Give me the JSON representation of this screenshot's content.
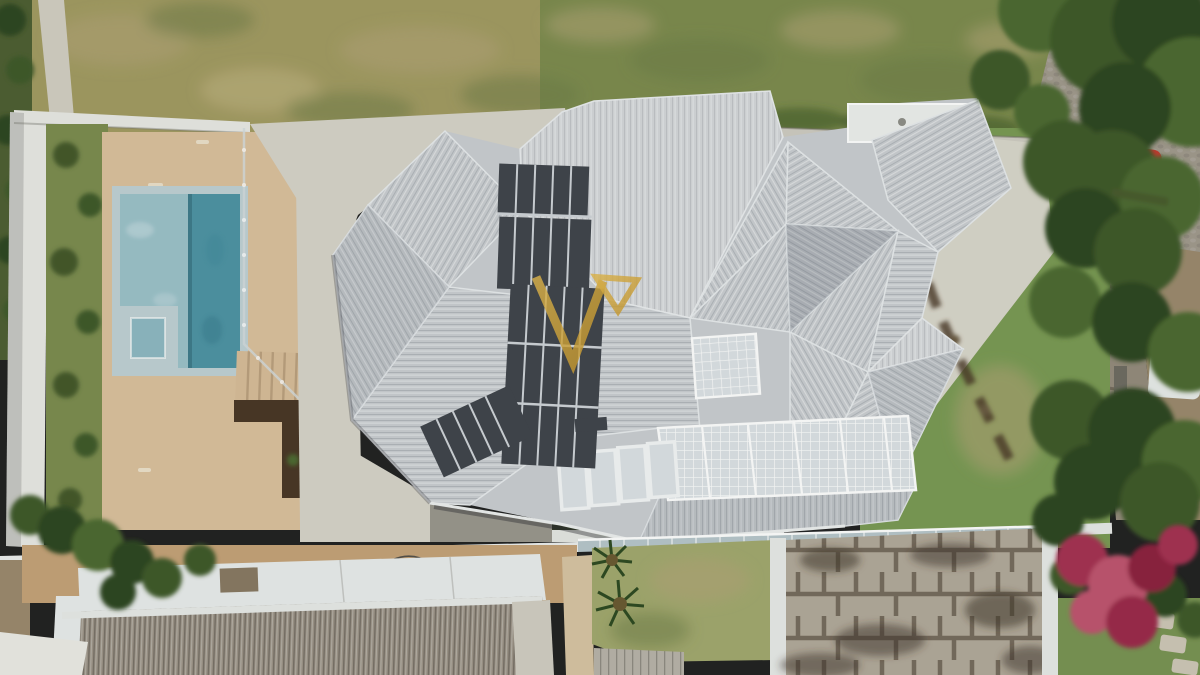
{
  "scene": {
    "type": "aerial-drone-photograph",
    "description": "Top-down aerial view of a modern residence with a multi-faceted light gray roof, rooftop solar collectors and gridded skylights, a swimming pool with tan deck and spa on the left, lawns, a curved concrete driveway, a cobbled street with parked red car and white van at right under large trees, and neighboring houses along the bottom with corrugated roof, palm lawn, weathered stone patio and magenta bougainvillea.",
    "visible_text": "",
    "watermark": {
      "shape": "gold outlined V with small inverted triangle (logo monogram)",
      "position": "center of roof"
    }
  },
  "elements": [
    {
      "name": "house-roof",
      "desc": "gray ribbed hip roof, many facets with white ridge lines"
    },
    {
      "name": "solar-arrays",
      "desc": "dark solar water-heating strips on left roof planes"
    },
    {
      "name": "skylight-grid",
      "desc": "white gridded glass roof sections, center and lower band"
    },
    {
      "name": "pool",
      "desc": "rectangular pool, light shallow half and deep teal half, square spa"
    },
    {
      "name": "pool-deck",
      "desc": "tan paved deck with glass fence and timber steps"
    },
    {
      "name": "boundary-wall",
      "desc": "white perimeter wall, left and top"
    },
    {
      "name": "driveway",
      "desc": "light concrete drive curving to street"
    },
    {
      "name": "street",
      "desc": "cobblestone road with yellow dashed center line"
    },
    {
      "name": "red-car",
      "desc": "red car parked under tree"
    },
    {
      "name": "white-van",
      "desc": "white van on right verge"
    },
    {
      "name": "trees",
      "desc": "dense green canopies along right edge"
    },
    {
      "name": "neighbor-corrugated-roof",
      "desc": "gray-brown corrugated roof, bottom left"
    },
    {
      "name": "neighbor-lawn-palms",
      "desc": "small lawn with two palms, bottom center"
    },
    {
      "name": "stone-patio",
      "desc": "cracked weathered slab patio, bottom right"
    },
    {
      "name": "bougainvillea",
      "desc": "magenta flowering canopy, bottom right corner"
    }
  ],
  "colors": {
    "lawn_top_left": "#a39b63",
    "lawn_top_right": "#7e8c4f",
    "lawn_right": "#7b9a55",
    "lawn_bottom": "#a3a96f",
    "lawn_flowers": "#7a9454",
    "weeds_dark": "#4e5f33",
    "wall_white": "#e9e9e5",
    "concrete_path": "#d7d4ca",
    "driveway": "#dad7cc",
    "deck_tan": "#dcc19e",
    "deck_steps": "#d8bd99",
    "pool_coping": "#c0d1d5",
    "pool_shallow": "#9cc2ca",
    "pool_deep": "#4e94a5",
    "spa_water": "#8fb9c3",
    "mulch_dark": "#4a3726",
    "roof_base": "#cbced2",
    "ridge_white": "#eef0f2",
    "solar_dark": "#41454c",
    "solar_frame": "#cfd3d8",
    "skylight": "#dde2e6",
    "panel_frame": "#f4f6f7",
    "terrace_white": "#eef0ee",
    "road_cobble": "#a29a8e",
    "road_line_yellow": "#c8b14b",
    "sidewalk": "#cfccc2",
    "stone_wall": "#958c7d",
    "dirt": "#9c8a6e",
    "car_red": "#c63a30",
    "van_white": "#e8ebe9",
    "tree_green_dark": "#2f4720",
    "tree_green_mid": "#3f5a2a",
    "tree_green_light": "#4e6a33",
    "shrub_green": "#44582c",
    "yard_tan": "#c6a379",
    "flat_roof_white": "#e9ecec",
    "corrugated_roof": "#9d9488",
    "walkway_gray": "#d2cec3",
    "walkway_beige": "#d8c5a4",
    "palm_green": "#2f4a22",
    "timber_deck": "#b9b4aa",
    "patio_stone": "#b3aa9b",
    "patio_joint": "#4f4336",
    "moss_dark": "#3e3328",
    "pergola_white": "#e8eae8",
    "bougainvillea": "#a63352",
    "bougainvillea_light": "#c05570",
    "glass_fence": "#b8c7cc",
    "fence_white": "#edefee",
    "under_eave": "#33392a",
    "watermark_gold": "#c9992e",
    "watermark_gold_light": "#e3b84d"
  }
}
